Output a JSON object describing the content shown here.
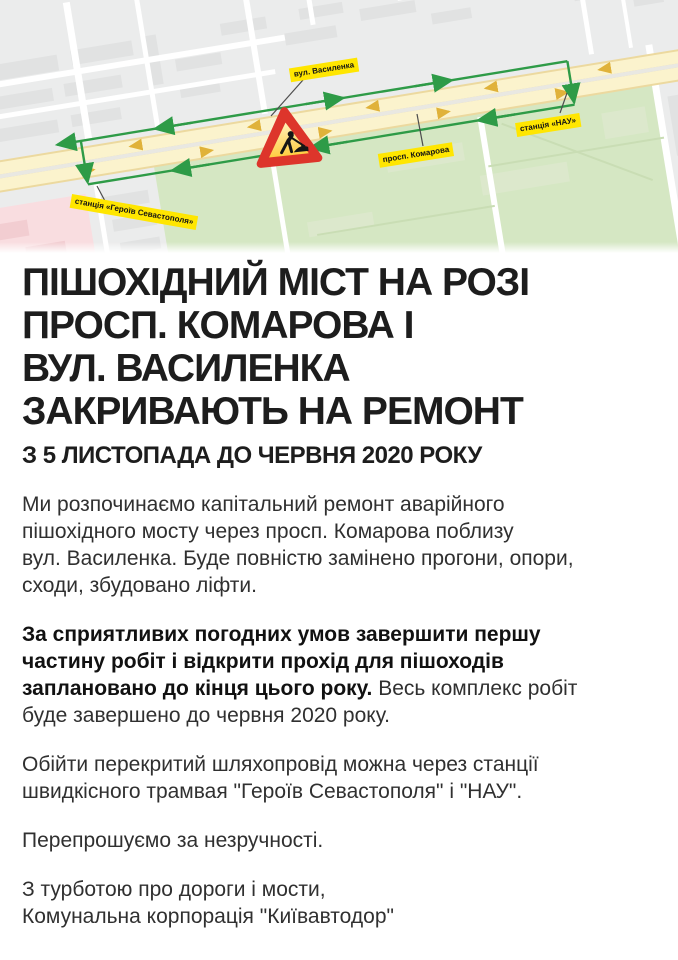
{
  "map": {
    "labels": {
      "vasylenka": "вул. Василенка",
      "komarova": "просп. Комарова",
      "nau": "станція «НАУ»",
      "heroiv": "станція «Героїв Севастополя»"
    },
    "colors": {
      "label_bg": "#ffe600",
      "detour_green": "#2e9b47",
      "road_fill": "#fbf3cd",
      "road_edge": "#ecd99f",
      "road_arrow": "#e0b23a",
      "park_green": "#d5e7c3",
      "pink_zone": "#f9dde0",
      "sign_red": "#dd352b",
      "sign_yellow": "#ffd75e",
      "map_bg": "#ebecec"
    }
  },
  "announcement": {
    "headline": "ПІШОХІДНИЙ МІСТ НА РОЗІ\nПРОСП. КОМАРОВА І\nВУЛ. ВАСИЛЕНКА\nЗАКРИВАЮТЬ НА РЕМОНТ",
    "subheadline": "З 5 ЛИСТОПАДА ДО ЧЕРВНЯ 2020 РОКУ",
    "paragraph_intro": "Ми розпочинаємо капітальний ремонт аварійного\nпішохідного мосту через просп. Комарова поблизу\nвул. Василенка. Буде повністю замінено прогони, опори,\nсходи, збудовано ліфти.",
    "paragraph_schedule_bold": "За сприятливих погодних умов завершити першу\nчастину робіт і відкрити прохід для пішоходів\nзаплановано до кінця цього року.",
    "paragraph_schedule_rest": " Весь комплекс робіт\nбуде завершено до червня 2020 року.",
    "paragraph_detour": "Обійти перекритий шляхопровід можна через станції\nшвидкісного трамвая \"Героїв Севастополя\" і \"НАУ\".",
    "paragraph_apology": "Перепрошуємо за незручності.",
    "signature": "З турботою про дороги і мости,\nКомунальна корпорація \"Київавтодор\""
  }
}
